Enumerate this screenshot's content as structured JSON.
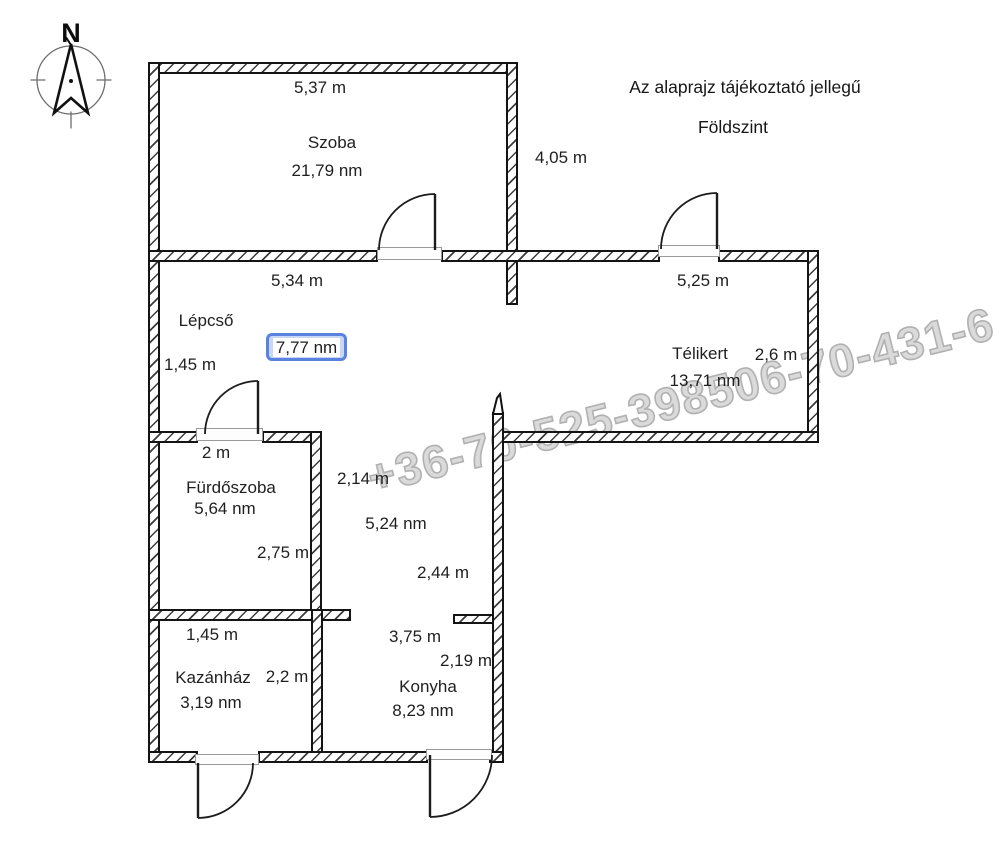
{
  "header": {
    "disclaimer": "Az alaprajz tájékoztató jellegű",
    "floor_label": "Földszint"
  },
  "compass": {
    "label": "N"
  },
  "watermark": {
    "text": "+36-70-525-398506-70-431-6",
    "color": "#b9b9b9"
  },
  "selection": {
    "border_color": "#5b82dd",
    "fill_color": "#c8d7f5"
  },
  "rooms": {
    "szoba": {
      "name": "Szoba",
      "area": "21,79 nm",
      "width": "5,37 m",
      "height": "4,05 m"
    },
    "lepcso": {
      "name": "Lépcső",
      "area": "7,77 nm",
      "width": "5,34 m",
      "height": "1,45 m"
    },
    "telikert": {
      "name": "Télikert",
      "area": "13,71 nm",
      "width": "5,25 m",
      "depth": "2,6 m"
    },
    "furdoszoba": {
      "name": "Fürdőszoba",
      "area": "5,64 nm",
      "width": "2 m",
      "height": "2,75 m"
    },
    "kazanhaz": {
      "name": "Kazánház",
      "area": "3,19 nm",
      "width": "1,45 m",
      "depth": "2,2 m"
    },
    "konyha": {
      "name": "Konyha",
      "area": "8,23 nm",
      "width": "3,75 m",
      "depth": "2,19 m"
    },
    "hall": {
      "area": "5,24 nm",
      "dim_a": "2,14 m",
      "dim_b": "2,44 m"
    }
  }
}
